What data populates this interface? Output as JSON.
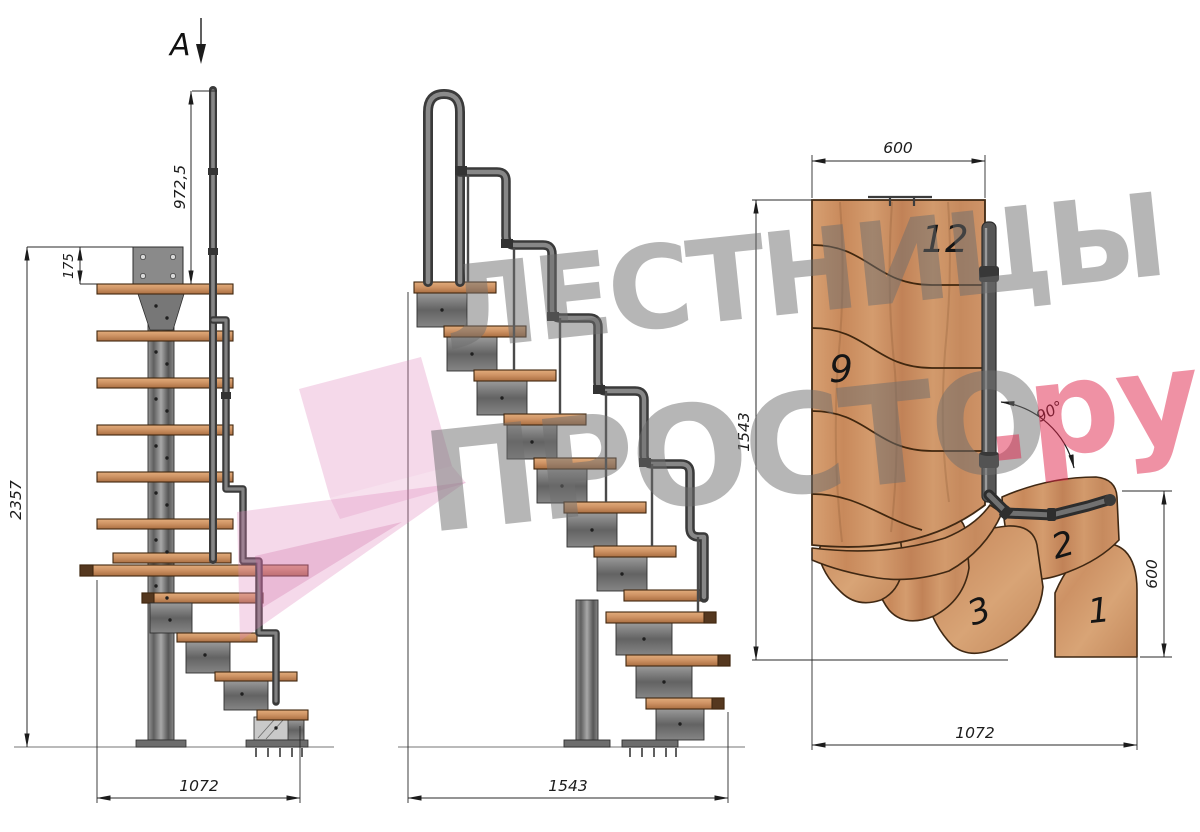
{
  "page": {
    "background": "#ffffff"
  },
  "section_marker": {
    "label": "A"
  },
  "side_view": {
    "dims": {
      "handrail_height": "972,5",
      "plate_offset": "175",
      "total_height": "2357",
      "footprint_length": "1072"
    }
  },
  "front_view": {
    "dims": {
      "footprint_length": "1543"
    }
  },
  "plan_view": {
    "dims": {
      "flight_width": "600",
      "total_depth": "1543",
      "entry_width": "600",
      "total_length": "1072",
      "turn_angle": "90°"
    },
    "step_labels": {
      "s12": "12",
      "s9": "9",
      "s3": "3",
      "s2": "2",
      "s1": "1"
    }
  },
  "watermark": {
    "line1": "ЛЕСТНИЦЫ",
    "line2": "ПРОСТО",
    "suffix": ".ру"
  },
  "colors": {
    "wood": "#cf9466",
    "steel": "#6f6f6f",
    "dimension": "#1c1c1c",
    "watermark_gray": "#9a9a9a",
    "watermark_pink": "#e39fc7",
    "watermark_red": "#e14a6d"
  }
}
